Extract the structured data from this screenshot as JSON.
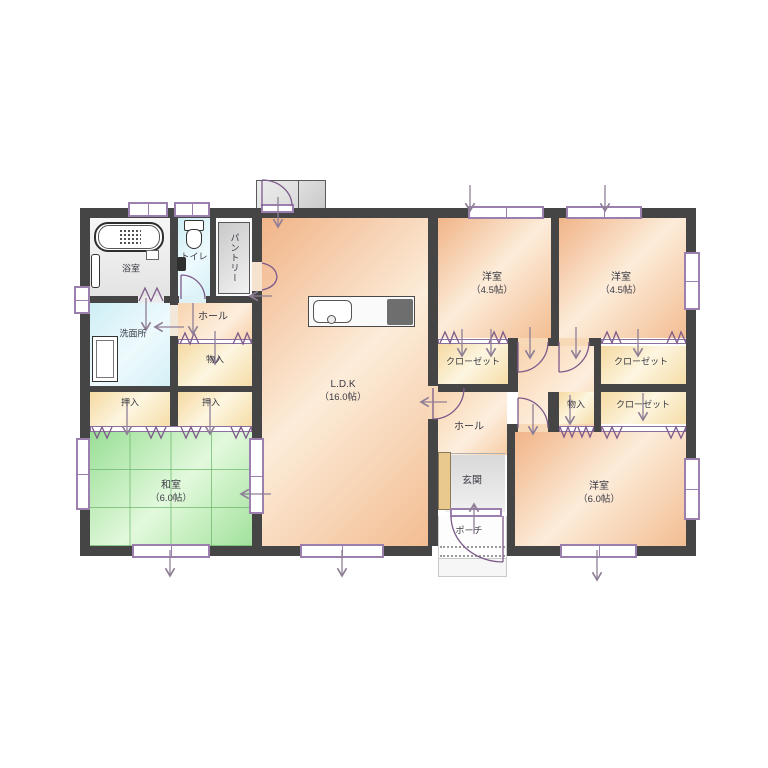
{
  "plan": {
    "type": "japanese-house-floor-plan",
    "rooms": {
      "bathroom": {
        "label": "浴室"
      },
      "toilet": {
        "label": "トイレ"
      },
      "pantry": {
        "label": "パントリー"
      },
      "washroom": {
        "label": "洗面所"
      },
      "hall_left": {
        "label": "ホール"
      },
      "storage_left": {
        "label": "物入"
      },
      "oshiire_1": {
        "label": "押入"
      },
      "oshiire_2": {
        "label": "押入"
      },
      "washitsu": {
        "label": "和室",
        "size": "（6.0帖）"
      },
      "ldk": {
        "label": "L.D.K",
        "size": "（16.0帖）"
      },
      "bedroom_1": {
        "label": "洋室",
        "size": "（4.5帖）"
      },
      "bedroom_2": {
        "label": "洋室",
        "size": "（4.5帖）"
      },
      "closet_1": {
        "label": "クローゼット"
      },
      "closet_2": {
        "label": "クローゼット"
      },
      "closet_3": {
        "label": "クローゼット"
      },
      "storage_right": {
        "label": "物入"
      },
      "hall_right": {
        "label": "ホール"
      },
      "genkan": {
        "label": "玄関"
      },
      "porch": {
        "label": "ポーチ"
      },
      "bedroom_3": {
        "label": "洋室",
        "size": "（6.0帖）"
      }
    },
    "colors": {
      "wall": "#454545",
      "opening_accent": "#8b6f9e",
      "window_frame": "#9b7fae",
      "flooring_peach": "#f6cda4",
      "storage_cream": "#f9e9c0",
      "tatami_green": "#a8e3a0",
      "water_cyan": "#d9f1f6",
      "entrance_gray": "#e2e2e2",
      "cabinet_tan": "#eac98f",
      "arrow_gray": "#8f7f96"
    }
  }
}
